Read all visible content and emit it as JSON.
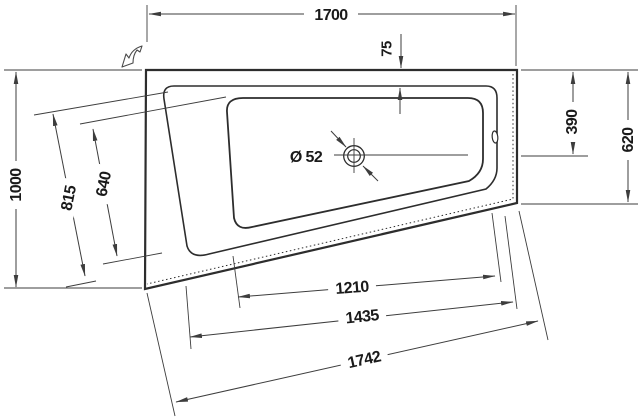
{
  "drawing": {
    "description": "Plan-view technical drawing of an asymmetric trapezoid bathtub with millimetre dimensions",
    "colors": {
      "outline": "#2d2d2d",
      "dimension_lines": "#3d3d3d",
      "label_text": "#1a1a1a",
      "background": "#ffffff"
    },
    "labels": {
      "top_width": "1700",
      "rim_width_top": "75",
      "drain_center_from_top": "390",
      "right_side_depth": "620",
      "overall_depth_left": "1000",
      "rim_left_edge": "815",
      "basin_left_edge": "640",
      "basin_bottom_edge": "1210",
      "rim_bottom_edge": "1435",
      "outer_bottom_edge": "1742",
      "drain_diameter": "Ø 52"
    }
  }
}
